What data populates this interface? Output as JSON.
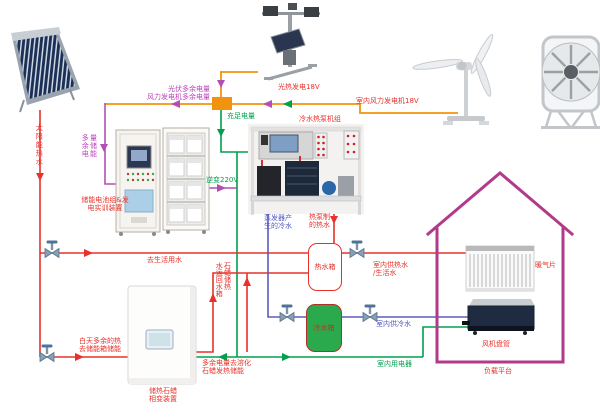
{
  "colors": {
    "power_line_orange": "#f2930d",
    "battery_line_magenta": "#b34fb3",
    "electric_line_green": "#00a04d",
    "hot_water_line_red": "#e8312a",
    "cold_water_line_blue": "#5b5bbf",
    "house_outline_magenta": "#b23a8a",
    "cold_tank_green": "#2aa94d"
  },
  "generation": {
    "solar_collector_label": "太阳能热水",
    "solar_thermal_label": "光热发电18V",
    "wind_label": "室内风力发电机18V",
    "pv_surplus_label": "光伏多余电量\n风力发电机多余电量",
    "sufficient_label": "充足电量"
  },
  "storage": {
    "surplus_store_label": "多余电\n量储能",
    "battery_cabinet_label": "储能电池组&发\n电实训装置",
    "inverter_label": "逆变220V",
    "pcm_label": "储热石蜡\n相变装置",
    "day_surplus_label": "白天多余的热\n去储能箱储能",
    "melt_label": "多余电量去溶化\n石蜡发热储能",
    "return_label": "石蜡储热\n水运回水箱"
  },
  "heat_pump": {
    "title": "冷水热泵机组",
    "evaporator_label": "蒸发器产\n生的冷水",
    "hot_out_label": "热泵制\n的热水"
  },
  "tanks": {
    "hot_label": "热水箱",
    "cold_label": "冷水箱",
    "to_domestic_label": "去生活用水",
    "hot_supply_label": "室内供热水\n/生活水",
    "cold_supply_label": "室内供冷水",
    "power_supply_label": "室内用电器"
  },
  "house": {
    "radiator_label": "暖气片",
    "fan_coil_label": "风机盘管",
    "platform_label": "负载平台"
  }
}
